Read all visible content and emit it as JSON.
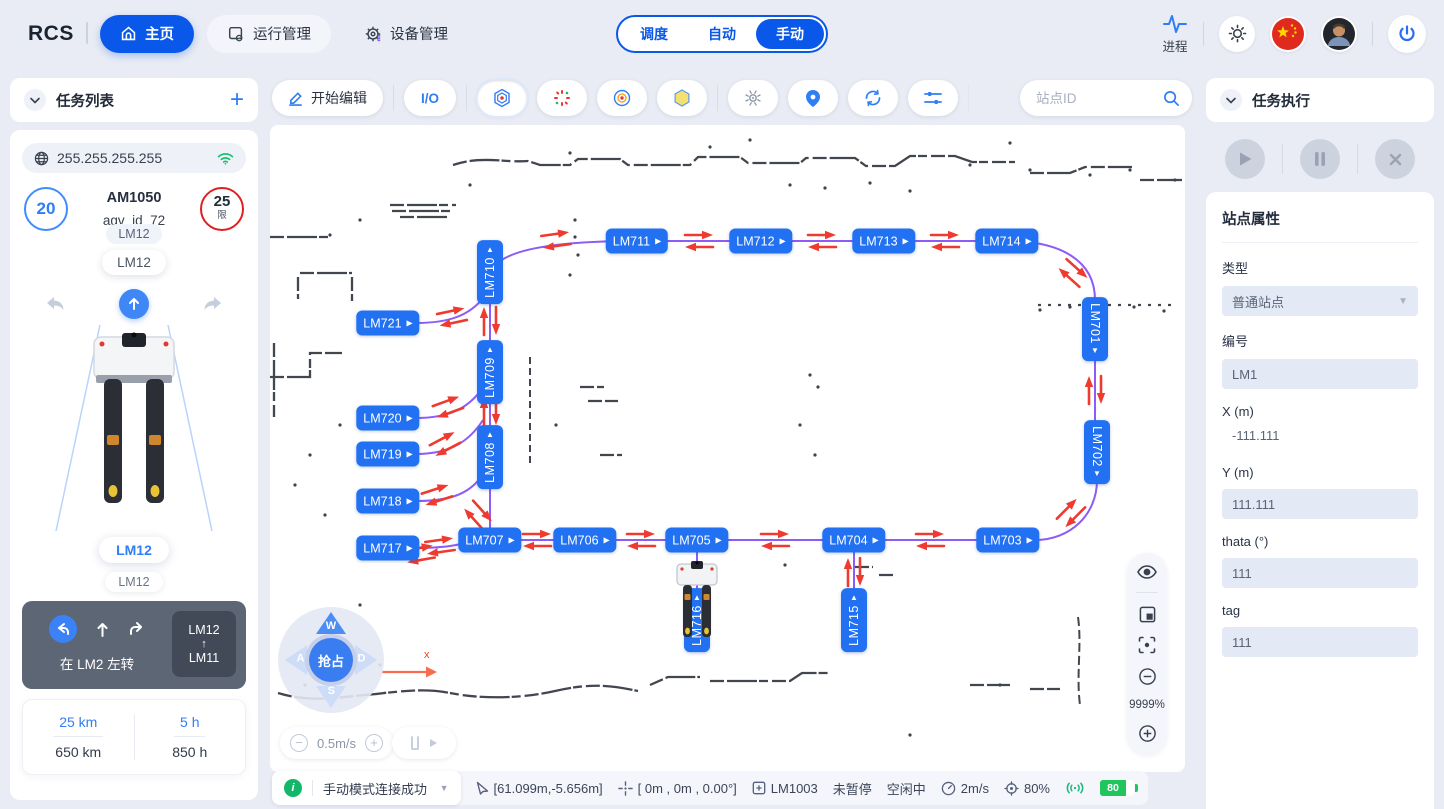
{
  "nav": {
    "logo": "RCS",
    "tabs": [
      {
        "label": "主页"
      },
      {
        "label": "运行管理"
      },
      {
        "label": "设备管理"
      }
    ],
    "modes": [
      "调度",
      "自动",
      "手动"
    ],
    "active_mode": "手动",
    "process_label": "进程"
  },
  "left_panel": {
    "header": "任务列表",
    "ip": "255.255.255.255",
    "speed_badge": "20",
    "limit_value": "25",
    "limit_suffix": "限",
    "model": "AM1050",
    "agv_id": "agv_id_72",
    "chip_small": "LM12",
    "chip_large": "LM12",
    "station_primary": "LM12",
    "station_secondary": "LM12",
    "nav_card": {
      "action_text": "在 LM2 左转",
      "from": "LM12",
      "arrow": "↑",
      "to": "LM11"
    },
    "stats": [
      {
        "value": "25 km",
        "total": "650 km"
      },
      {
        "value": "5 h",
        "total": "850 h"
      }
    ]
  },
  "toolbar": {
    "edit_label": "开始编辑",
    "io_label": "I/O",
    "search_placeholder": "站点ID"
  },
  "map": {
    "zoom_level": "9999%",
    "axis_label": "x",
    "joystick": {
      "center": "抢占",
      "up": "W",
      "left": "A",
      "down": "S",
      "right": "D"
    },
    "speed_control": {
      "value": "0.5m/s",
      "minus": "−",
      "plus": "+"
    },
    "nodes": [
      {
        "label": "LM710",
        "x": 220,
        "y": 147,
        "orient": "v",
        "tri": "up"
      },
      {
        "label": "LM709",
        "x": 220,
        "y": 247,
        "orient": "v",
        "tri": "up"
      },
      {
        "label": "LM708",
        "x": 220,
        "y": 332,
        "orient": "v",
        "tri": "up"
      },
      {
        "label": "LM711",
        "x": 367,
        "y": 116,
        "orient": "h",
        "tri": "right"
      },
      {
        "label": "LM712",
        "x": 491,
        "y": 116,
        "orient": "h",
        "tri": "right"
      },
      {
        "label": "LM713",
        "x": 614,
        "y": 116,
        "orient": "h",
        "tri": "right"
      },
      {
        "label": "LM714",
        "x": 737,
        "y": 116,
        "orient": "h",
        "tri": "right"
      },
      {
        "label": "LM701",
        "x": 825,
        "y": 204,
        "orient": "v",
        "tri": "down"
      },
      {
        "label": "LM702",
        "x": 827,
        "y": 327,
        "orient": "v",
        "tri": "down"
      },
      {
        "label": "LM703",
        "x": 738,
        "y": 415,
        "orient": "h",
        "tri": "right"
      },
      {
        "label": "LM704",
        "x": 584,
        "y": 415,
        "orient": "h",
        "tri": "right"
      },
      {
        "label": "LM705",
        "x": 427,
        "y": 415,
        "orient": "h",
        "tri": "right"
      },
      {
        "label": "LM706",
        "x": 315,
        "y": 415,
        "orient": "h",
        "tri": "right"
      },
      {
        "label": "LM707",
        "x": 220,
        "y": 415,
        "orient": "h",
        "tri": "right"
      },
      {
        "label": "LM721",
        "x": 118,
        "y": 198,
        "orient": "h",
        "tri": "right"
      },
      {
        "label": "LM720",
        "x": 118,
        "y": 293,
        "orient": "h",
        "tri": "right"
      },
      {
        "label": "LM719",
        "x": 118,
        "y": 329,
        "orient": "h",
        "tri": "right"
      },
      {
        "label": "LM718",
        "x": 118,
        "y": 376,
        "orient": "h",
        "tri": "right"
      },
      {
        "label": "LM717",
        "x": 118,
        "y": 423,
        "orient": "h",
        "tri": "right"
      },
      {
        "label": "LM716",
        "x": 427,
        "y": 495,
        "orient": "v",
        "tri": "up"
      },
      {
        "label": "LM715",
        "x": 584,
        "y": 495,
        "orient": "v",
        "tri": "up"
      }
    ],
    "arrows": [
      {
        "x": 286,
        "y": 115,
        "rot": -8
      },
      {
        "x": 429,
        "y": 116,
        "rot": 0
      },
      {
        "x": 552,
        "y": 116,
        "rot": 0
      },
      {
        "x": 675,
        "y": 116,
        "rot": 0
      },
      {
        "x": 803,
        "y": 148,
        "rot": 42
      },
      {
        "x": 825,
        "y": 265,
        "rot": -90
      },
      {
        "x": 801,
        "y": 388,
        "rot": 135
      },
      {
        "x": 170,
        "y": 421,
        "rot": -8
      },
      {
        "x": 267,
        "y": 415,
        "rot": 0
      },
      {
        "x": 371,
        "y": 415,
        "rot": 0
      },
      {
        "x": 505,
        "y": 415,
        "rot": 0
      },
      {
        "x": 660,
        "y": 415,
        "rot": 0
      },
      {
        "x": 220,
        "y": 196,
        "rot": -90
      },
      {
        "x": 220,
        "y": 286,
        "rot": -90
      },
      {
        "x": 584,
        "y": 447,
        "rot": -90
      },
      {
        "x": 182,
        "y": 192,
        "rot": -12
      },
      {
        "x": 178,
        "y": 282,
        "rot": -20
      },
      {
        "x": 175,
        "y": 319,
        "rot": -28
      },
      {
        "x": 167,
        "y": 370,
        "rot": -18
      },
      {
        "x": 208,
        "y": 390,
        "rot": 48
      },
      {
        "x": 150,
        "y": 429,
        "rot": -10
      }
    ]
  },
  "right_panel": {
    "header": "任务执行",
    "section_title": "站点属性",
    "fields": {
      "type": {
        "label": "类型",
        "value": "普通站点"
      },
      "code": {
        "label": "编号",
        "value": "LM1"
      },
      "x": {
        "label": "X (m)",
        "value": "-111.111"
      },
      "y": {
        "label": "Y (m)",
        "value": "111.111"
      },
      "theta": {
        "label": "thata (°)",
        "value": "111"
      },
      "tag": {
        "label": "tag",
        "value": "111"
      }
    }
  },
  "status_bar": {
    "message": "手动模式连接成功",
    "cursor_pos": "[61.099m,-5.656m]",
    "robot_pos": "[ 0m , 0m , 0.00°]",
    "station": "LM1003",
    "pause_state": "未暂停",
    "idle_state": "空闲中",
    "speed": "2m/s",
    "confidence": "80%",
    "battery": "80"
  }
}
